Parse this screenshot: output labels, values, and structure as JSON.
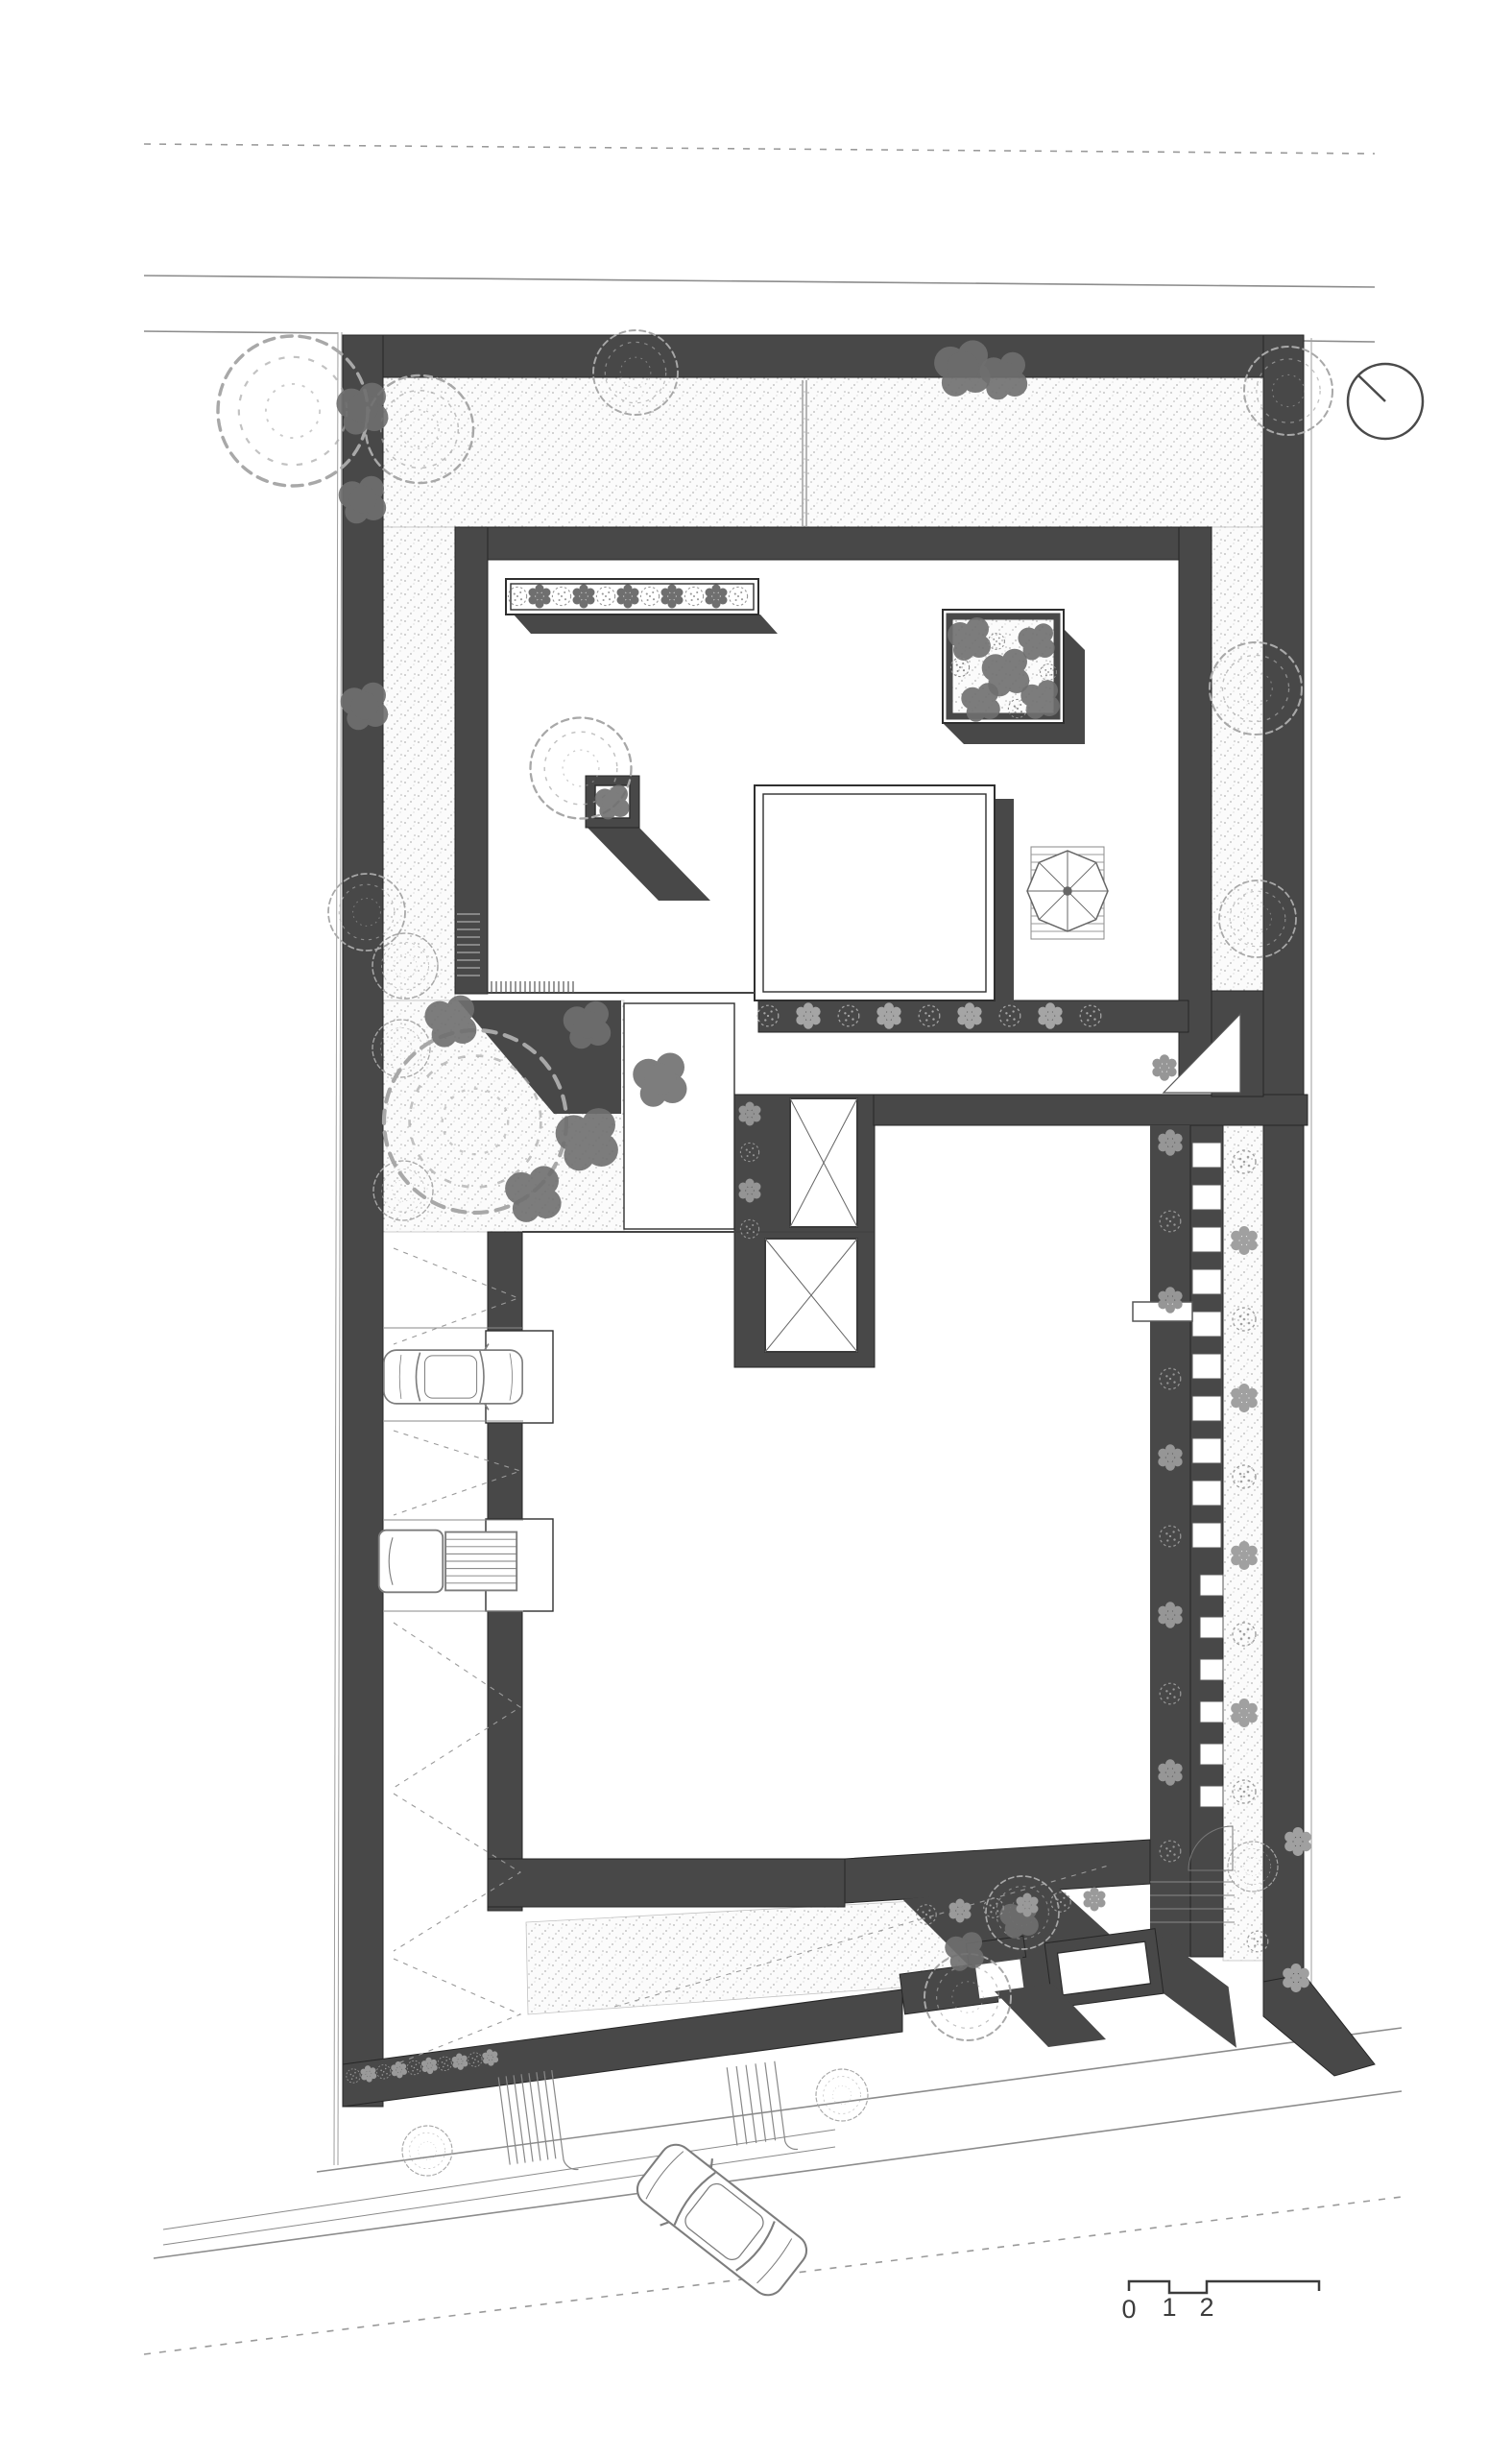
{
  "page": {
    "type": "architectural-site-plan",
    "background": "#ffffff"
  },
  "colors": {
    "wall": "#484848",
    "stipple_dot": "#b5b5b5",
    "stipple_bg": "#fbfbfb",
    "tree_outline": "#a8a8a8",
    "shrub_dark": "#6f6f6f",
    "shrub_light": "#969696",
    "thin_line": "#555555",
    "road_line": "#8c8c8c",
    "text": "#3c3c3c"
  },
  "scale_bar": {
    "labels": [
      "0",
      "1",
      "2",
      "5"
    ]
  },
  "north_arrow": {
    "icon": "north-arrow-icon"
  }
}
